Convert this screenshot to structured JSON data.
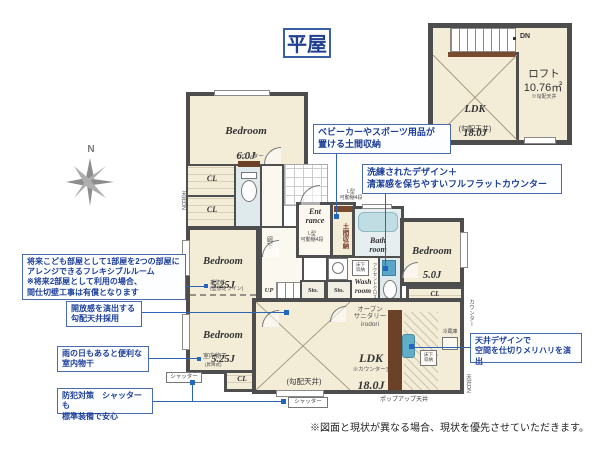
{
  "page": {
    "title": "平屋",
    "footnote": "※図面と現状が異なる場合、現状を優先させていただきます。"
  },
  "colors": {
    "wall": "#4d4d4d",
    "floor": "#f3ecd7",
    "callout_text": "#1d3f9a",
    "callout_border": "#4a6cae",
    "accent_blue": "#5ba6c6",
    "counter_brown": "#6b4128"
  },
  "compass": {
    "north": "N"
  },
  "loft_plan": {
    "dn": "DN",
    "ldk": {
      "name": "LDK",
      "size": "18.0J",
      "ceiling": "(勾配天井)"
    },
    "loft": {
      "name": "ロフト",
      "area": "10.76㎡",
      "note": "※勾配天井"
    }
  },
  "floor_plan": {
    "rooms": {
      "bed6": {
        "name": "Bedroom",
        "size": "6.0J"
      },
      "bed525a": {
        "name": "Bedroom",
        "size": "5.25J"
      },
      "bed525b": {
        "name": "Bedroom",
        "size": "5.25J"
      },
      "bed5": {
        "name": "Bedroom",
        "size": "5.0J"
      },
      "ldk": {
        "name": "LDK",
        "size": "18.0J",
        "note": "※カウンター含",
        "ceiling": "(勾配天井)"
      },
      "entrance": "Ent\nrance",
      "bath": "Bath\nroom",
      "wash": "Wash\nroom",
      "sto": "Sto.",
      "doma": "土間収納",
      "hall": "廊下",
      "up": "UP"
    },
    "labels": {
      "cl": "CL",
      "counter": "カウンター",
      "ceiling_dn": "天井DN",
      "l_shelf": "L型\n可動棚4段",
      "washer": "洗濯機",
      "underfloor": "床下\n収納",
      "fridge": "冷蔵庫",
      "accent_cloth": "アクセントクロス",
      "open_sanitary": "オープン\nサニタリー\nirodori",
      "partition": "垂壁芯\n(壁想定ライン)",
      "monohoshi": "室内物干",
      "monohoshi_sub": "(昇降式)",
      "shutter": "シャッター",
      "popup_ceiling": "ポップアップ天井"
    },
    "callouts": {
      "doma": "ベビーカーやスポーツ用品が\n置ける土間収納",
      "counter": "洗練されたデザイン＋\n清潔感を保ちやすいフルフラットカウンター",
      "flexible": "将来こども部屋として1部屋を2つの部屋に\nアレンジできるフレキシブルルーム\n※将来2部屋として利用の場合、\n間仕切壁工事は有償となります",
      "ceiling": "開放感を演出する\n勾配天井採用",
      "monohoshi": "雨の日もあると便利な\n室内物干",
      "security": "防犯対策　シャッターも\n標準装備で安心",
      "ceiling_design": "天井デザインで\n空間を仕切りメリハリを演出"
    }
  }
}
